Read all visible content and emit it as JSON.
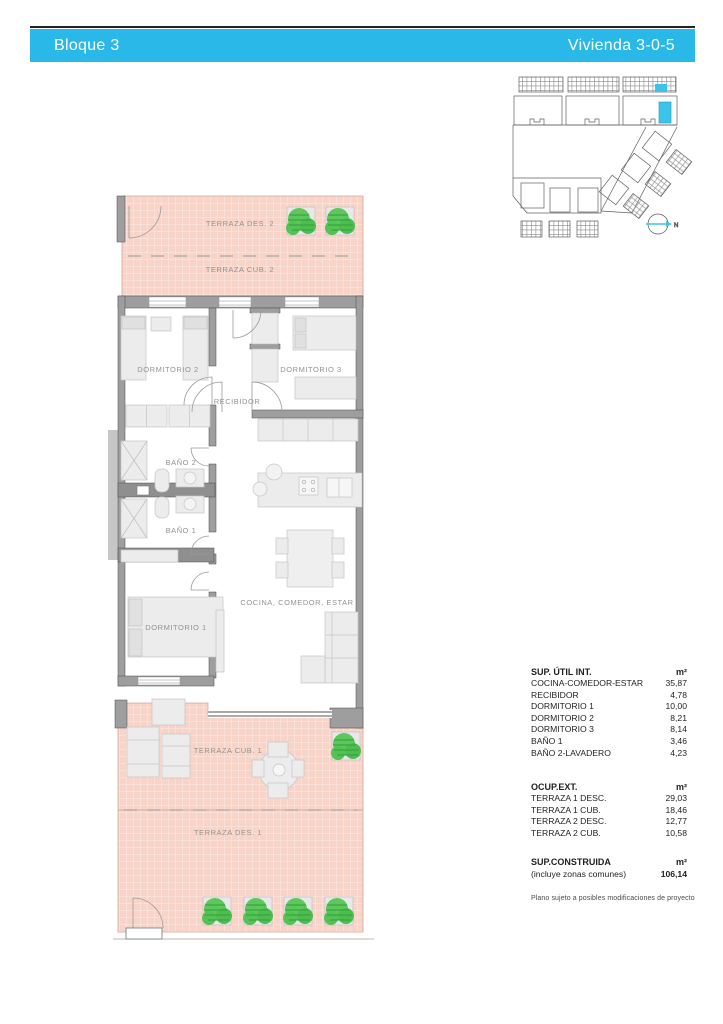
{
  "header": {
    "block": "Bloque 3",
    "unit": "Vivienda 3-0-5",
    "accent_color": "#29b8e8"
  },
  "site_plan": {
    "north_label": "N",
    "highlight_color": "#3bc3e8"
  },
  "floor_plan": {
    "rooms": {
      "terraza_des_2": "TERRAZA DES. 2",
      "terraza_cub_2": "TERRAZA CUB. 2",
      "dormitorio_2": "DORMITORIO 2",
      "dormitorio_3": "DORMITORIO 3",
      "recibidor": "RECIBIDOR",
      "bano_2": "BAÑO 2",
      "bano_1": "BAÑO 1",
      "dormitorio_1": "DORMITORIO 1",
      "cocina": "COCINA, COMEDOR, ESTAR",
      "terraza_cub_1": "TERRAZA CUB. 1",
      "terraza_des_1": "TERRAZA DES. 1"
    },
    "terrace_color": "#f8d3c8",
    "wall_color": "#9e9e9e"
  },
  "areas": {
    "interior": {
      "title": "SUP. ÚTIL INT.",
      "unit": "m²",
      "rows": [
        {
          "label": "COCINA-COMEDOR-ESTAR",
          "value": "35,87"
        },
        {
          "label": "RECIBIDOR",
          "value": "4,78"
        },
        {
          "label": "DORMITORIO 1",
          "value": "10,00"
        },
        {
          "label": "DORMITORIO 2",
          "value": "8,21"
        },
        {
          "label": "DORMITORIO 3",
          "value": "8,14"
        },
        {
          "label": "BAÑO 1",
          "value": "3,46"
        },
        {
          "label": "BAÑO 2-LAVADERO",
          "value": "4,23"
        }
      ]
    },
    "exterior": {
      "title": "OCUP.EXT.",
      "unit": "m²",
      "rows": [
        {
          "label": "TERRAZA 1 DESC.",
          "value": "29,03"
        },
        {
          "label": "TERRAZA 1 CUB.",
          "value": "18,46"
        },
        {
          "label": "TERRAZA 2 DESC.",
          "value": "12,77"
        },
        {
          "label": "TERRAZA 2 CUB.",
          "value": "10,58"
        }
      ]
    },
    "constructed": {
      "title": "SUP.CONSTRUIDA",
      "unit": "m²",
      "subtitle": "(incluye zonas comunes)",
      "value": "106,14"
    },
    "disclaimer": "Plano sujeto a posibles modificaciones de proyecto"
  }
}
